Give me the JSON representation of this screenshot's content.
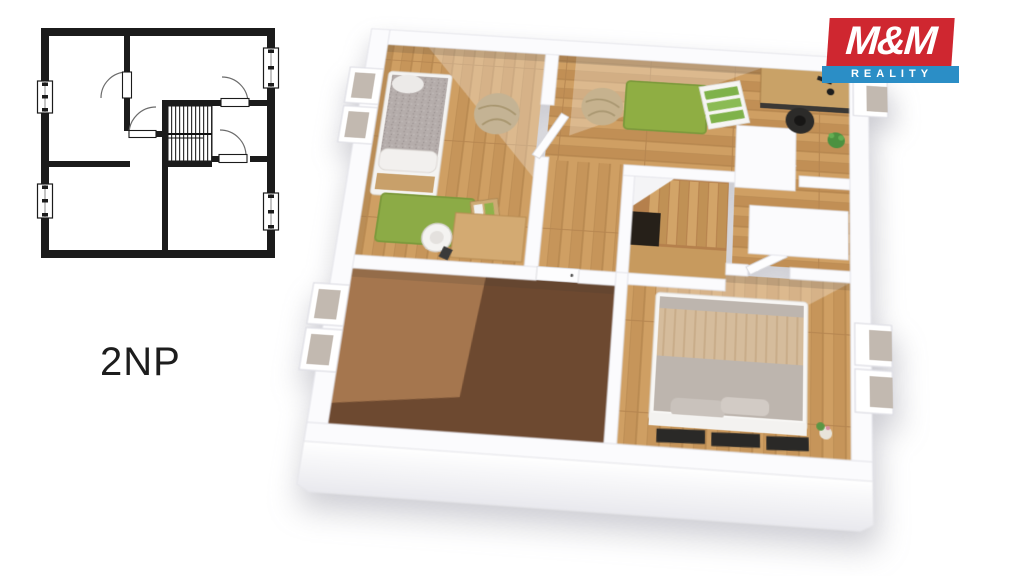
{
  "page": {
    "background": "#ffffff"
  },
  "floor_plan_2d": {
    "label": "2NP",
    "line_color": "#1b1b1b",
    "features": [
      "4 rooms",
      "central staircase",
      "2 windows left wall",
      "2 windows right wall",
      "4 door swings"
    ]
  },
  "logo": {
    "brand": "M&M",
    "subtitle": "REALITY",
    "brand_bg": "#cf2730",
    "subtitle_bg": "#2b8ec6",
    "text_color": "#ffffff"
  },
  "floor_plan_3d": {
    "rooms": [
      {
        "name": "children-bedroom",
        "floor": "wood",
        "furniture": [
          "single-bed",
          "green-rug",
          "desk",
          "white-chair",
          "beanbag"
        ]
      },
      {
        "name": "study-room",
        "floor": "wood",
        "furniture": [
          "beanbag",
          "green-rug",
          "green-dresser",
          "desk",
          "black-chair",
          "plant",
          "wardrobe"
        ]
      },
      {
        "name": "hallway-staircase",
        "floor": "wood",
        "furniture": [
          "staircase",
          "white-door"
        ]
      },
      {
        "name": "attic-room",
        "floor": "brown",
        "furniture": []
      },
      {
        "name": "master-bedroom",
        "floor": "wood",
        "furniture": [
          "double-bed",
          "pillows",
          "dark-sideboard-units",
          "flower"
        ]
      }
    ],
    "colors": {
      "wall": "#fbfbfd",
      "wood_floor": "#cf9f63",
      "brown_floor_dark": "#6d4930",
      "brown_floor_light": "#a5764e",
      "rug_green": "#8cab46",
      "bed_gray": "#bdb5ae",
      "throw_beige": "#d5bc9c",
      "accent_dark": "#2a2927",
      "plant_green": "#4c9140"
    }
  }
}
